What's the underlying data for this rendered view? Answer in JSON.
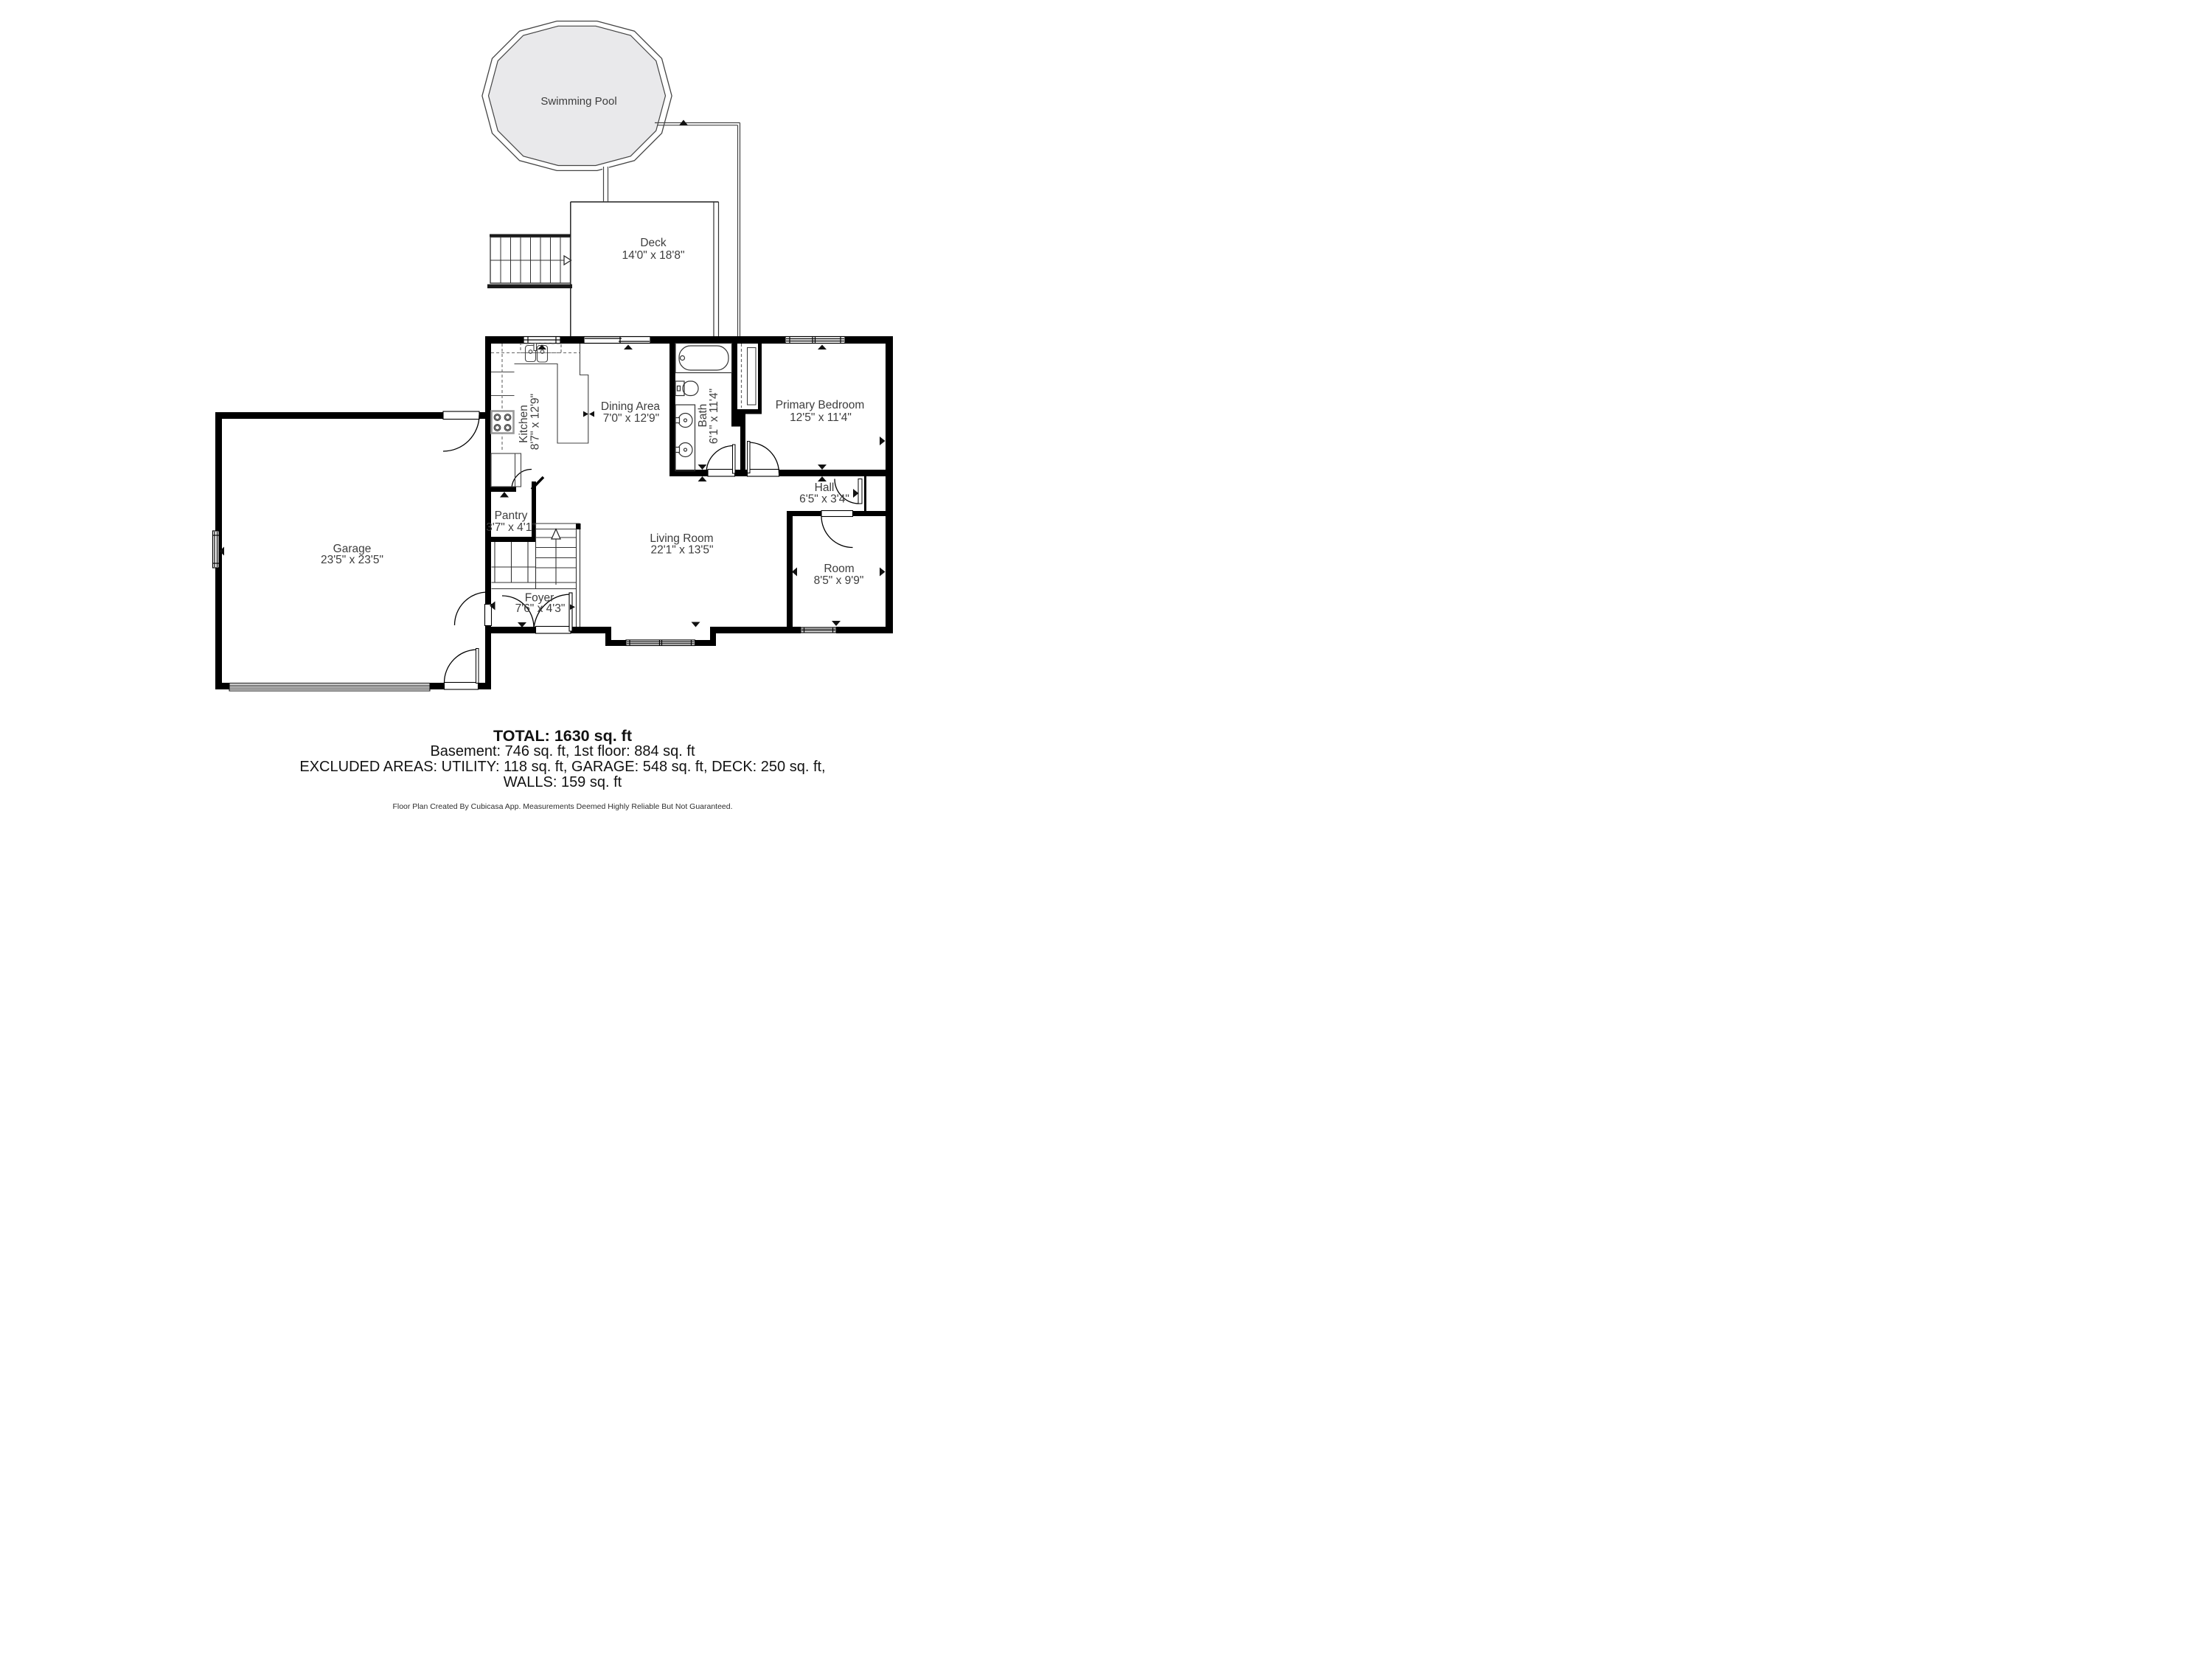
{
  "colors": {
    "wall": "#000000",
    "pool_fill": "#e9e9eb",
    "thin_line": "#3a3a3a",
    "label_text": "#3d3d3d"
  },
  "rooms": {
    "swimming_pool": {
      "label": "Swimming Pool"
    },
    "deck": {
      "label": "Deck",
      "dims": "14'0\" x 18'8\""
    },
    "kitchen": {
      "label": "Kitchen",
      "dims": "8'7\" x 12'9\""
    },
    "dining": {
      "label": "Dining Area",
      "dims": "7'0\" x 12'9\""
    },
    "bath": {
      "label": "Bath",
      "dims": "6'1\" x 11'4\""
    },
    "primary_bedroom": {
      "label": "Primary Bedroom",
      "dims": "12'5\" x 11'4\""
    },
    "hall": {
      "label": "Hall",
      "dims": "6'5\" x 3'4\""
    },
    "room": {
      "label": "Room",
      "dims": "8'5\" x 9'9\""
    },
    "living": {
      "label": "Living Room",
      "dims": "22'1\" x 13'5\""
    },
    "garage": {
      "label": "Garage",
      "dims": "23'5\" x 23'5\""
    },
    "pantry": {
      "label": "Pantry",
      "dims": "3'7\" x 4'1\""
    },
    "foyer": {
      "label": "Foyer",
      "dims": "7'6\" x 4'3\""
    }
  },
  "summary": {
    "total": "TOTAL: 1630 sq. ft",
    "line2": "Basement: 746 sq. ft, 1st floor: 884 sq. ft",
    "line3": "EXCLUDED AREAS: UTILITY: 118 sq. ft, GARAGE: 548 sq. ft, DECK: 250 sq. ft,",
    "line4": "WALLS: 159 sq. ft"
  },
  "footer": "Floor Plan Created By Cubicasa App. Measurements Deemed Highly Reliable But Not Guaranteed."
}
